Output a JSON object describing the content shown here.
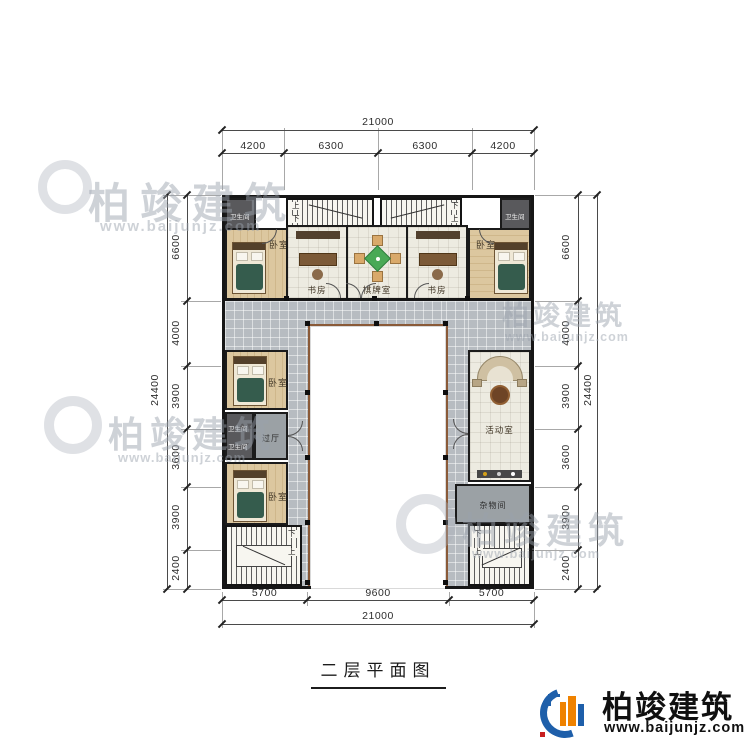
{
  "title": "二层平面图",
  "logo": {
    "name": "柏竣建筑",
    "url": "www.baijunjz.com"
  },
  "watermark": {
    "name": "柏竣建筑",
    "url": "www.baijunjz.com"
  },
  "rooms": {
    "bedroom": "卧室",
    "study": "书房",
    "mahjong": "棋牌室",
    "bathroom": "卫生间",
    "hall": "过厅",
    "activity": "活动室",
    "storage": "杂物间"
  },
  "stairs": {
    "up": "上",
    "down": "下"
  },
  "dimensions": {
    "top": {
      "total": "21000",
      "segments": [
        "4200",
        "6300",
        "6300",
        "4200"
      ]
    },
    "bottom": {
      "total": "21000",
      "segments": [
        "5700",
        "9600",
        "5700"
      ]
    },
    "left": {
      "total": "24400",
      "segments": [
        "6600",
        "4000",
        "3900",
        "3600",
        "3900",
        "2400"
      ]
    },
    "right": {
      "total": "24400",
      "segments": [
        "6600",
        "4000",
        "3900",
        "3600",
        "3900",
        "2400"
      ]
    }
  }
}
